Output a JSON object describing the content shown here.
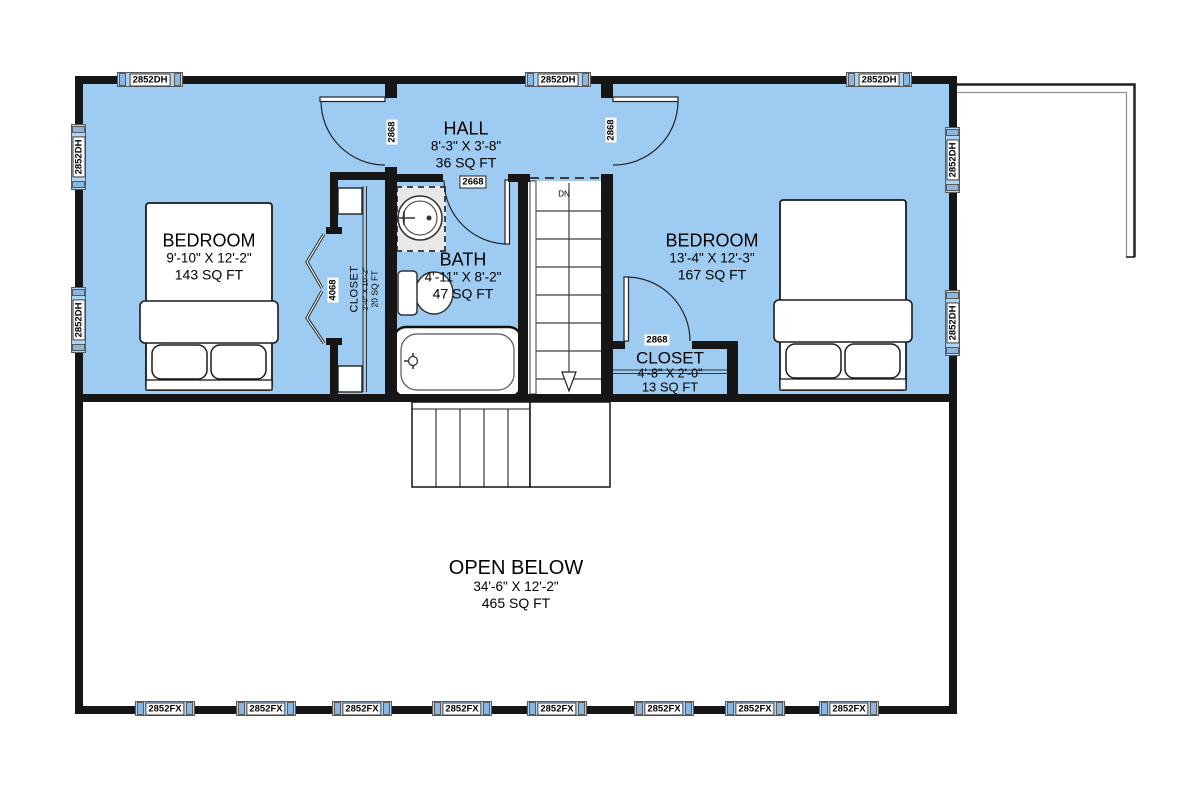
{
  "floor_plan": {
    "rooms": {
      "bedroom_left": {
        "name": "BEDROOM",
        "dims": "9'-10\" X 12'-2\"",
        "area": "143 SQ FT"
      },
      "bedroom_right": {
        "name": "BEDROOM",
        "dims": "13'-4\" X 12'-3\"",
        "area": "167 SQ FT"
      },
      "hall": {
        "name": "HALL",
        "dims": "8'-3\" X 3'-8\"",
        "area": "36 SQ FT"
      },
      "bath": {
        "name": "BATH",
        "dims": "4'-11\" X 8'-2\"",
        "area": "47 SQ FT"
      },
      "closet_left": {
        "name": "CLOSET",
        "dims": "2'-0\" X 10'-2\"",
        "area": "20 SQ FT"
      },
      "closet_right": {
        "name": "CLOSET",
        "dims": "4'-8\" X 2'-0\"",
        "area": "13 SQ FT"
      },
      "open_below": {
        "name": "OPEN BELOW",
        "dims": "34'-6\" X 12'-2\"",
        "area": "465 SQ FT"
      }
    },
    "doors": {
      "hall_left_door": "2868",
      "hall_right_door": "2868",
      "bath_door": "2668",
      "closet_bifold_door": "4068",
      "closet_right_door": "2868"
    },
    "stairs": {
      "direction_label": "DN"
    },
    "windows": {
      "top": [
        "2852DH",
        "2852DH",
        "2852DH"
      ],
      "left": [
        "2852DH",
        "2852DH"
      ],
      "right": [
        "2852DH",
        "2852DH"
      ],
      "bottom": [
        "2852FX",
        "2852FX",
        "2852FX",
        "2852FX",
        "2852FX",
        "2852FX",
        "2852FX",
        "2852FX"
      ]
    },
    "colors": {
      "floor_fill": "#9ecbf1",
      "wall": "#161616",
      "window_glass": "#aed4f4"
    }
  }
}
